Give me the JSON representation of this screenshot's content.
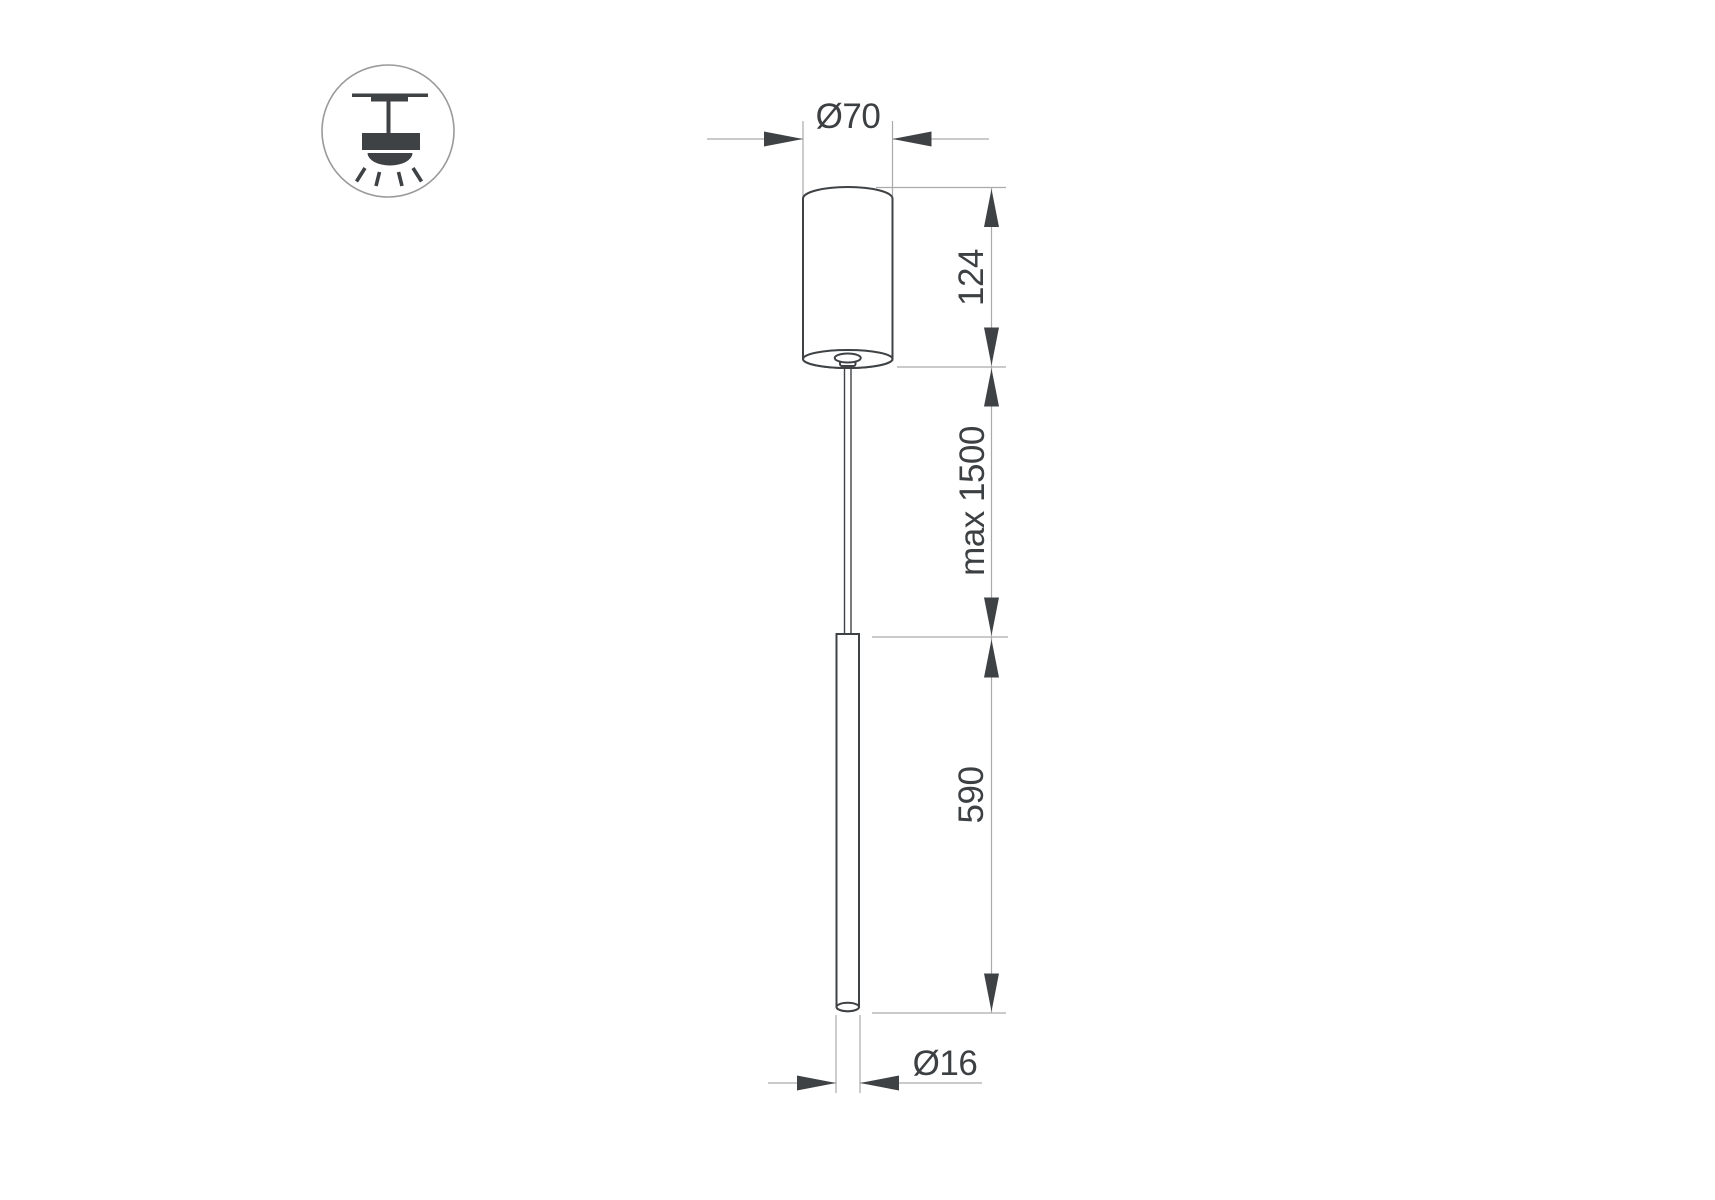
{
  "labels": {
    "canopy_diameter": "Ø70",
    "canopy_height": "124",
    "suspension_max_length": "max 1500",
    "tube_length": "590",
    "tube_diameter": "Ø16"
  },
  "icon": {
    "name": "pendant-ceiling-light-icon"
  },
  "colors": {
    "bg": "#ffffff",
    "outline": "#3f4245",
    "arrow": "#3f4245",
    "dimline": "#aaaaaa",
    "text": "#3d4043",
    "icon_fill": "#3f4245",
    "icon_circle": "#9a9a9a"
  }
}
